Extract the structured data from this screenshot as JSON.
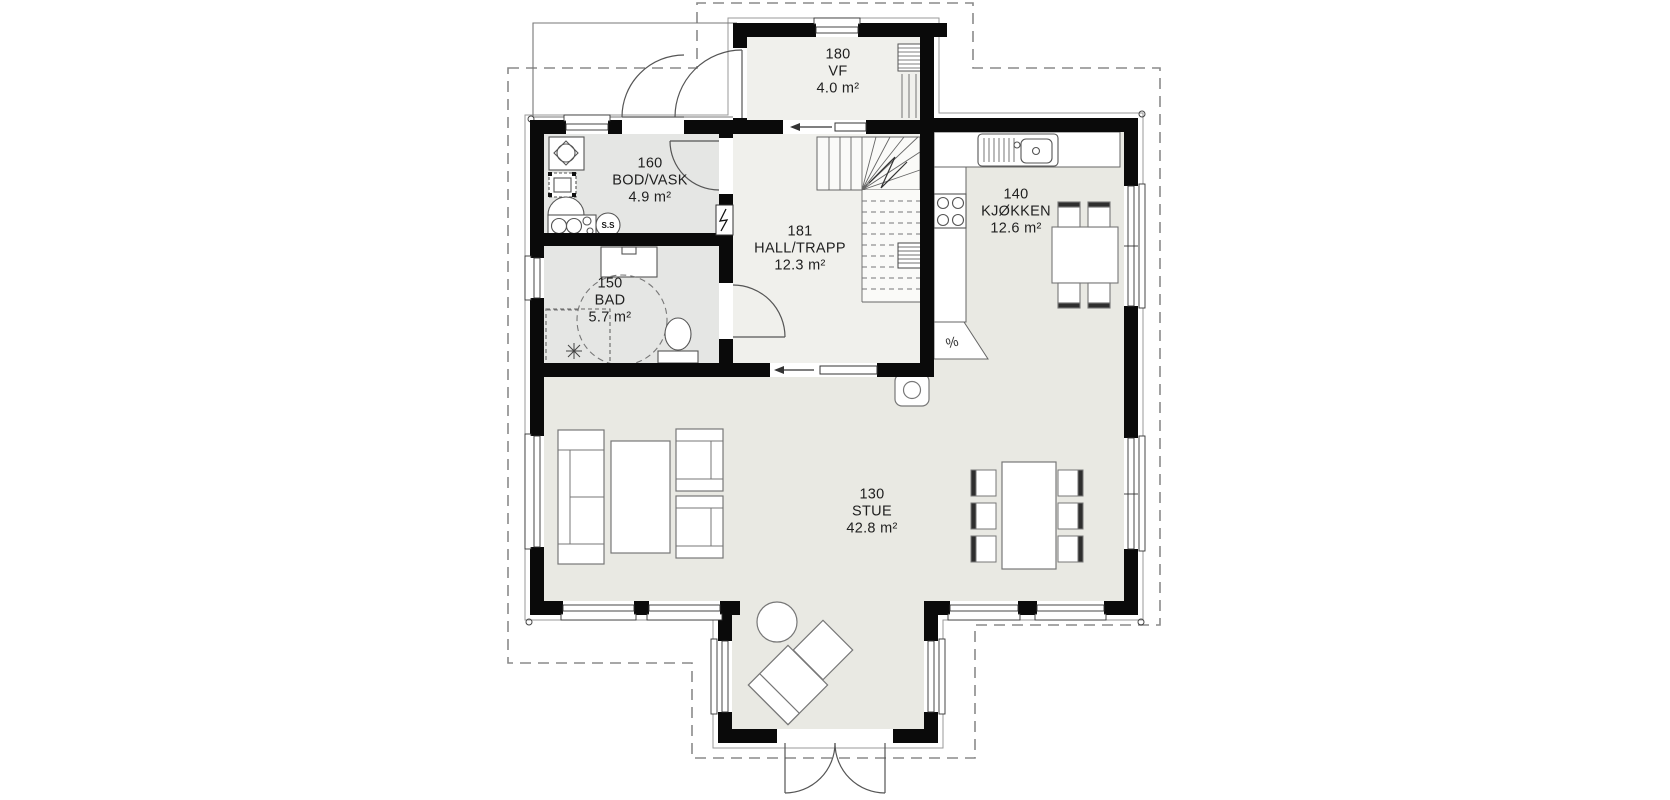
{
  "rooms": [
    {
      "number": "180",
      "name": "VF",
      "area": "4.0 m²"
    },
    {
      "number": "160",
      "name": "BOD/VASK",
      "area": "4.9 m²"
    },
    {
      "number": "181",
      "name": "HALL/TRAPP",
      "area": "12.3 m²"
    },
    {
      "number": "140",
      "name": "KJØKKEN",
      "area": "12.6 m²"
    },
    {
      "number": "150",
      "name": "BAD",
      "area": "5.7 m²"
    },
    {
      "number": "130",
      "name": "STUE",
      "area": "42.8 m²"
    }
  ],
  "annotations": {
    "floor_drain": "S.S",
    "counter_appliance": "%"
  },
  "colors": {
    "wall": "#0a0a0a",
    "floor_living": "#e9e9e3",
    "floor_wet": "#e5e6e4",
    "floor_hall": "#f0f0ec",
    "fixture_line": "#555555",
    "dashed_roof_outline": "#8a8a8a"
  }
}
